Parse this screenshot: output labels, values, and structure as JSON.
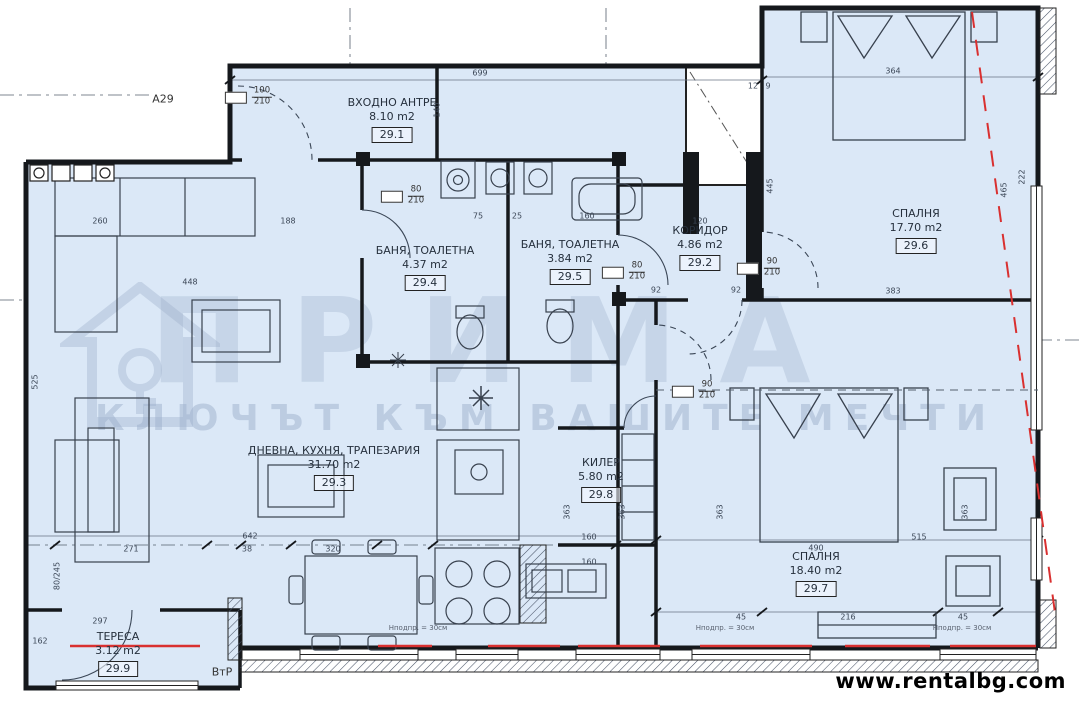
{
  "meta": {
    "sheet_label": "А29",
    "drawing_type": "floor-plan"
  },
  "footer": {
    "website": "www.rentalbg.com"
  },
  "watermark": {
    "brand": "ПРИМА",
    "slogan": "КЛЮЧЪТ КЪМ ВАШИТЕ МЕЧТИ"
  },
  "colors": {
    "floor": "#dbe8f7",
    "wall": "#15181c",
    "red_accent": "#d93030",
    "watermark": "#9eb0cb",
    "dim_text": "#3c4757"
  },
  "rooms": [
    {
      "name": "ВХОДНО АНТРЕ",
      "area": "8.10 m2",
      "num": "29.1",
      "x": 392,
      "y": 96
    },
    {
      "name": "КОРИДОР",
      "area": "4.86 m2",
      "num": "29.2",
      "x": 700,
      "y": 224
    },
    {
      "name": "ДНЕВНА, КУХНЯ, ТРАПЕЗАРИЯ",
      "area": "31.70 m2",
      "num": "29.3",
      "x": 334,
      "y": 444
    },
    {
      "name": "БАНЯ, ТОАЛЕТНА",
      "area": "4.37 m2",
      "num": "29.4",
      "x": 425,
      "y": 244
    },
    {
      "name": "БАНЯ, ТОАЛЕТНА",
      "area": "3.84 m2",
      "num": "29.5",
      "x": 570,
      "y": 238
    },
    {
      "name": "СПАЛНЯ",
      "area": "17.70 m2",
      "num": "29.6",
      "x": 916,
      "y": 207
    },
    {
      "name": "СПАЛНЯ",
      "area": "18.40 m2",
      "num": "29.7",
      "x": 816,
      "y": 550
    },
    {
      "name": "КИЛЕР",
      "area": "5.80 m2",
      "num": "29.8",
      "x": 601,
      "y": 456
    },
    {
      "name": "ТЕРЕСА",
      "area": "3.12 m2",
      "num": "29.9",
      "x": 118,
      "y": 630
    }
  ],
  "door_labels": [
    {
      "w": "100",
      "h": "210",
      "x": 262,
      "y": 97
    },
    {
      "w": "80",
      "h": "210",
      "x": 416,
      "y": 196
    },
    {
      "w": "80",
      "h": "210",
      "x": 637,
      "y": 272
    },
    {
      "w": "90",
      "h": "210",
      "x": 772,
      "y": 268
    },
    {
      "w": "90",
      "h": "210",
      "x": 707,
      "y": 391
    }
  ],
  "dimensions": [
    {
      "v": "699",
      "x": 480,
      "y": 73
    },
    {
      "v": "364",
      "x": 893,
      "y": 71
    },
    {
      "v": "12",
      "x": 753,
      "y": 86
    },
    {
      "v": "9",
      "x": 768,
      "y": 86
    },
    {
      "v": "140",
      "x": 437,
      "y": 110,
      "r": 90
    },
    {
      "v": "260",
      "x": 100,
      "y": 221
    },
    {
      "v": "188",
      "x": 288,
      "y": 221
    },
    {
      "v": "75",
      "x": 478,
      "y": 216
    },
    {
      "v": "25",
      "x": 517,
      "y": 216
    },
    {
      "v": "160",
      "x": 587,
      "y": 216
    },
    {
      "v": "120",
      "x": 700,
      "y": 221
    },
    {
      "v": "92",
      "x": 656,
      "y": 290
    },
    {
      "v": "92",
      "x": 736,
      "y": 290
    },
    {
      "v": "448",
      "x": 190,
      "y": 282
    },
    {
      "v": "383",
      "x": 893,
      "y": 291
    },
    {
      "v": "445",
      "x": 770,
      "y": 186,
      "r": 90
    },
    {
      "v": "465",
      "x": 1004,
      "y": 190,
      "r": 90
    },
    {
      "v": "222",
      "x": 1022,
      "y": 177,
      "r": 90
    },
    {
      "v": "525",
      "x": 35,
      "y": 382,
      "r": 90
    },
    {
      "v": "363",
      "x": 567,
      "y": 512,
      "r": 90
    },
    {
      "v": "363",
      "x": 622,
      "y": 512,
      "r": 90
    },
    {
      "v": "363",
      "x": 720,
      "y": 512,
      "r": 90
    },
    {
      "v": "363",
      "x": 965,
      "y": 512,
      "r": 90
    },
    {
      "v": "160",
      "x": 589,
      "y": 537
    },
    {
      "v": "515",
      "x": 919,
      "y": 537
    },
    {
      "v": "642",
      "x": 250,
      "y": 536
    },
    {
      "v": "271",
      "x": 131,
      "y": 549
    },
    {
      "v": "38",
      "x": 247,
      "y": 549
    },
    {
      "v": "320",
      "x": 333,
      "y": 549
    },
    {
      "v": "490",
      "x": 816,
      "y": 548
    },
    {
      "v": "160",
      "x": 589,
      "y": 562
    },
    {
      "v": "80/245",
      "x": 57,
      "y": 576,
      "r": 90
    },
    {
      "v": "297",
      "x": 100,
      "y": 621
    },
    {
      "v": "162",
      "x": 40,
      "y": 641
    },
    {
      "v": "45",
      "x": 741,
      "y": 617
    },
    {
      "v": "216",
      "x": 848,
      "y": 617
    },
    {
      "v": "45",
      "x": 963,
      "y": 617
    }
  ],
  "notes": [
    {
      "text": "Нподпр. = 30см",
      "x": 418,
      "y": 628
    },
    {
      "text": "Нподпр. = 30см",
      "x": 725,
      "y": 628
    },
    {
      "text": "Нподпр. = 30см",
      "x": 962,
      "y": 628
    }
  ],
  "markers": [
    {
      "text": "А29",
      "x": 163,
      "y": 99
    },
    {
      "text": "ВтР",
      "x": 222,
      "y": 672
    }
  ]
}
